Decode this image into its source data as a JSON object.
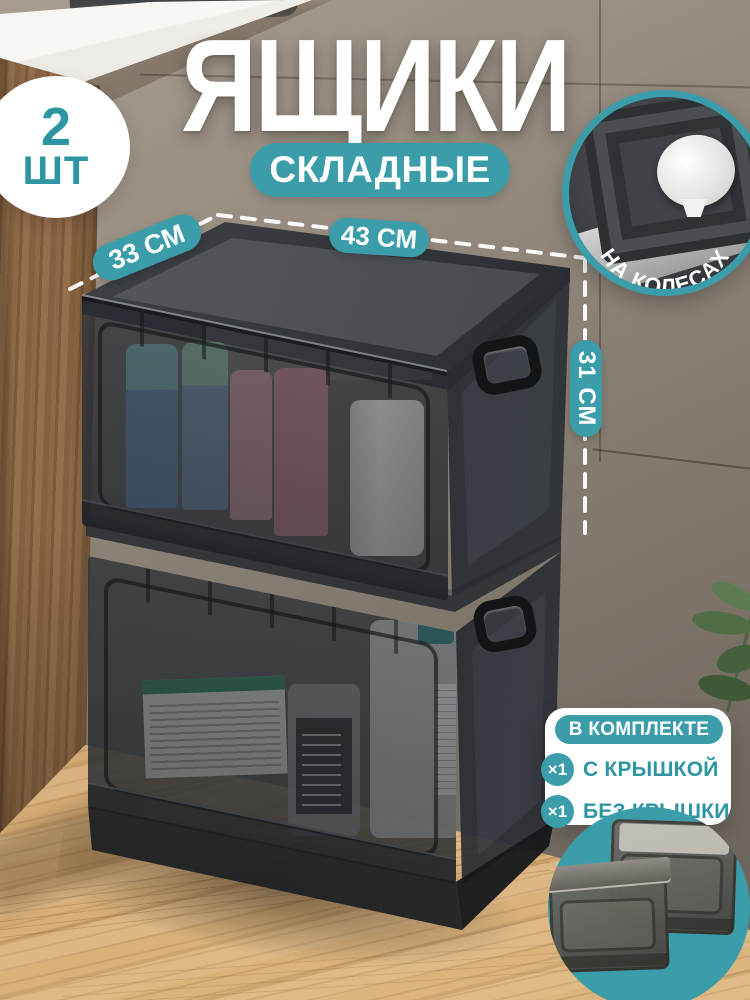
{
  "colors": {
    "accent": "#3B9DA9",
    "accent_text": "#2D96A2"
  },
  "badge": {
    "count": "2",
    "unit": "ШТ"
  },
  "title": "ЯЩИКИ",
  "subtitle": "СКЛАДНЫЕ",
  "wheels_label": "НА КОЛЕСАХ",
  "dimensions": {
    "depth": "33 СМ",
    "width": "43 СМ",
    "height": "31 СМ"
  },
  "included": {
    "header": "В КОМПЛЕКТЕ",
    "items": [
      {
        "qty": "×1",
        "label": "С КРЫШКОЙ"
      },
      {
        "qty": "×1",
        "label": "БЕЗ КРЫШКИ"
      }
    ]
  }
}
